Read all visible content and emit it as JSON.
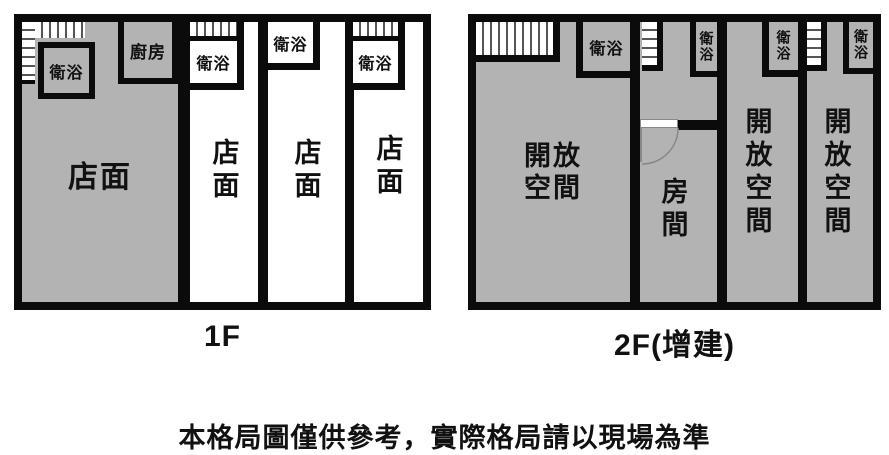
{
  "colors": {
    "wall": "#0b0b0b",
    "room_gray": "#b3b3b3",
    "paper": "#ffffff"
  },
  "floor1": {
    "caption": "1F",
    "unit1": {
      "storefront_label": "店面",
      "bathroom_label": "衛浴",
      "kitchen_label": "廚房"
    },
    "unit2": {
      "storefront_label": "店面",
      "bathroom_label": "衛浴"
    },
    "unit3": {
      "storefront_label": "店面",
      "bathroom_label": "衛浴"
    },
    "unit4": {
      "storefront_label": "店面",
      "bathroom_label": "衛浴"
    }
  },
  "floor2": {
    "caption": "2F(增建)",
    "unit1": {
      "room_label": "開放空間",
      "bathroom_label": "衛浴"
    },
    "unit2": {
      "room_label": "房間",
      "bathroom_label": "衛浴"
    },
    "unit3": {
      "room_label": "開放空間",
      "bathroom_label": "衛浴"
    },
    "unit4": {
      "room_label": "開放空間",
      "bathroom_label": "衛浴"
    }
  },
  "disclaimer": "本格局圖僅供參考，實際格局請以現場為準"
}
